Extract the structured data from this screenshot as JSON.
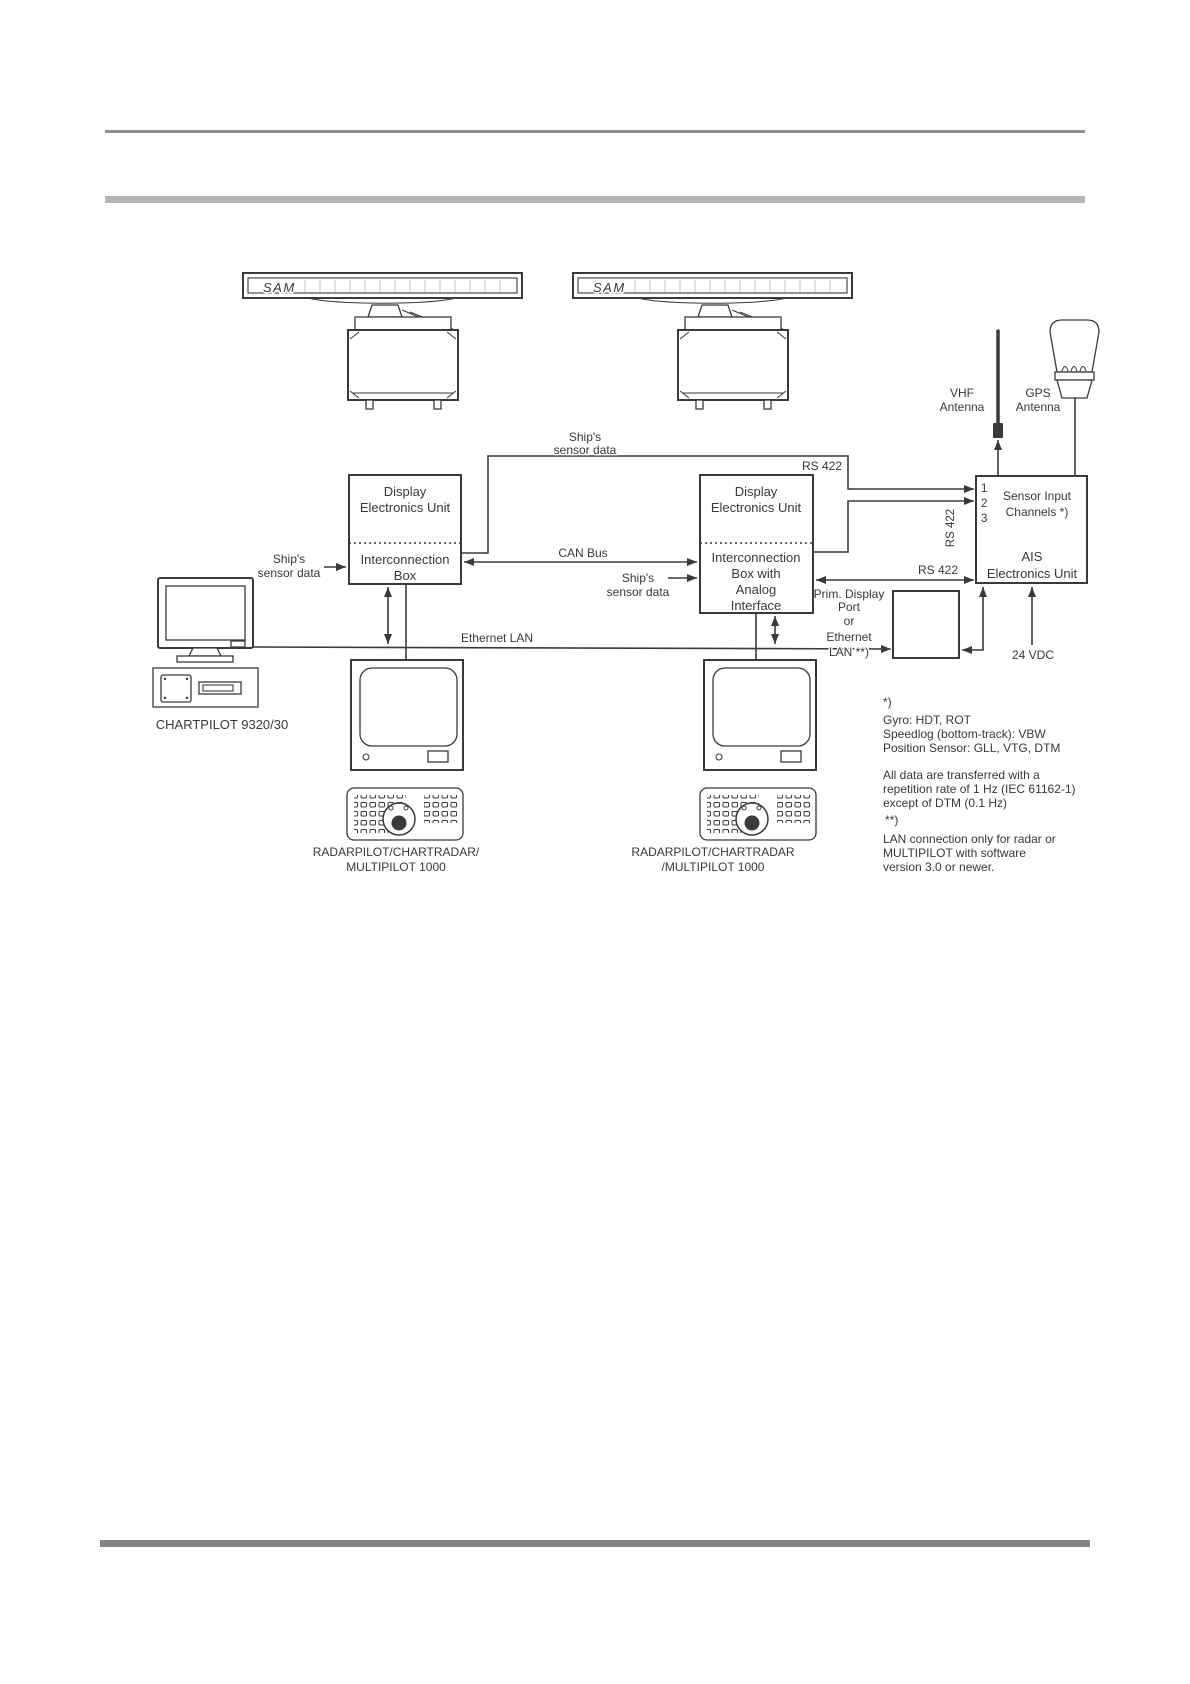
{
  "page": {
    "background": "#ffffff",
    "header_rule_color": "#8f8f8f",
    "section_bar_color": "#b6b6b6",
    "footer_bar_color": "#848484"
  },
  "diagram": {
    "radar_antenna_label": "SAM",
    "vhf_antenna": {
      "label_line1": "VHF",
      "label_line2": "Antenna"
    },
    "gps_antenna": {
      "label_line1": "GPS",
      "label_line2": "Antenna"
    },
    "deu_left": {
      "upper_line1": "Display",
      "upper_line2": "Electronics Unit",
      "lower_line1": "Interconnection",
      "lower_line2": "Box"
    },
    "deu_right": {
      "upper_line1": "Display",
      "upper_line2": "Electronics Unit",
      "lower_line1": "Interconnection",
      "lower_line2": "Box with",
      "lower_line3": "Analog",
      "lower_line4": "Interface"
    },
    "ais_unit": {
      "channel_1": "1",
      "channel_2": "2",
      "channel_3": "3",
      "input_line1": "Sensor Input",
      "input_line2": "Channels *)",
      "name_line1": "AIS",
      "name_line2": "Electronics Unit"
    },
    "chartpilot": {
      "label": "CHARTPILOT 9320/30"
    },
    "workstation_left": {
      "label_line1": "RADARPILOT/CHARTRADAR/",
      "label_line2": "MULTIPILOT 1000"
    },
    "workstation_right": {
      "label_line1": "RADARPILOT/CHARTRADAR",
      "label_line2": "/MULTIPILOT 1000"
    },
    "connections": {
      "ships_sensor_chartpilot_line1": "Ship's",
      "ships_sensor_chartpilot_line2": "sensor data",
      "ships_sensor_top_line1": "Ship's",
      "ships_sensor_top_line2": "sensor data",
      "ships_sensor_right_line1": "Ship's",
      "ships_sensor_right_line2": "sensor data",
      "can_bus": "CAN Bus",
      "ethernet_lan": "Ethernet LAN",
      "rs422_top": "RS 422",
      "rs422_vertical": "RS 422",
      "rs422_ch3": "RS 422",
      "prim_display_line1": "Prim. Display",
      "prim_display_line2": "Port",
      "prim_display_line3": "or",
      "prim_display_line4": "Ethernet",
      "prim_display_line5": "LAN **)",
      "power": "24 VDC"
    },
    "notes": {
      "star": "*)",
      "gyro": "Gyro: HDT, ROT",
      "speedlog": "Speedlog (bottom-track): VBW",
      "position": "Position Sensor: GLL, VTG, DTM",
      "data1": "All data are transferred with a",
      "data2": "repetition rate of 1 Hz (IEC 61162-1)",
      "data3": "except of DTM (0.1 Hz)",
      "doublestar": "**)",
      "lan1": "LAN connection only for radar or",
      "lan2": "MULTIPILOT with software",
      "lan3": "version 3.0 or newer."
    }
  }
}
